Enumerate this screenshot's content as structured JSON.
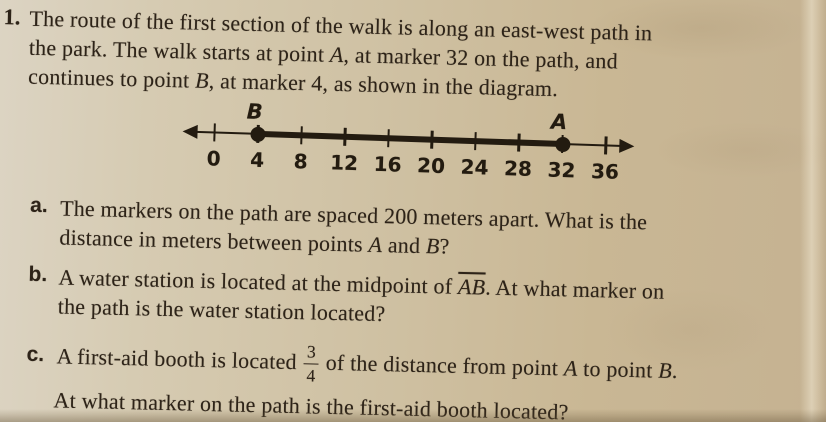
{
  "colors": {
    "paper": "#cfc1a3",
    "paper_light": "#dcd4c3",
    "paper_dark": "#c5b292",
    "ink": "#2d2318",
    "diagram_ink": "#231b10"
  },
  "problem": {
    "number_label": "1.",
    "lines": [
      [
        {
          "t": "The route of the first section of the walk is along an east-west path in"
        }
      ],
      [
        {
          "t": "the park. The walk starts at point "
        },
        {
          "t": "A",
          "i": 1
        },
        {
          "t": ", at marker 32 on the path, and"
        }
      ],
      [
        {
          "t": "continues to point "
        },
        {
          "t": "B",
          "i": 1
        },
        {
          "t": ", at marker 4, as shown in the diagram."
        }
      ]
    ]
  },
  "diagram": {
    "type": "number_line",
    "tick_step_units": 4,
    "tick_values": [
      "0",
      "4",
      "8",
      "12",
      "16",
      "20",
      "24",
      "28",
      "32",
      "36"
    ],
    "points": [
      {
        "label": "B",
        "value": 4
      },
      {
        "label": "A",
        "value": 32
      }
    ],
    "segment": {
      "from": 4,
      "to": 32
    }
  },
  "parts": {
    "a": {
      "label": "a.",
      "lines": [
        [
          {
            "t": "The markers on the path are spaced 200 meters apart. What is the"
          }
        ],
        [
          {
            "t": "distance in meters between points "
          },
          {
            "t": "A",
            "i": 1
          },
          {
            "t": " and "
          },
          {
            "t": "B",
            "i": 1
          },
          {
            "t": "?"
          }
        ]
      ]
    },
    "b": {
      "label": "b.",
      "lines": [
        [
          {
            "t": "A water station is located at the midpoint of "
          },
          {
            "t": "AB",
            "i": 1,
            "ov": 1
          },
          {
            "t": ". At what marker on"
          }
        ],
        [
          {
            "t": "the path is the water station located?"
          }
        ]
      ]
    },
    "c": {
      "label": "c.",
      "line1_pre": [
        {
          "t": "A first-aid booth is located"
        }
      ],
      "frac": {
        "num": "3",
        "den": "4"
      },
      "line1_post": [
        {
          "t": "of the distance from point "
        },
        {
          "t": "A",
          "i": 1
        },
        {
          "t": " to point "
        },
        {
          "t": "B",
          "i": 1
        },
        {
          "t": "."
        }
      ],
      "line2": [
        {
          "t": "At what marker on the path is the first-aid booth located?"
        }
      ]
    }
  }
}
